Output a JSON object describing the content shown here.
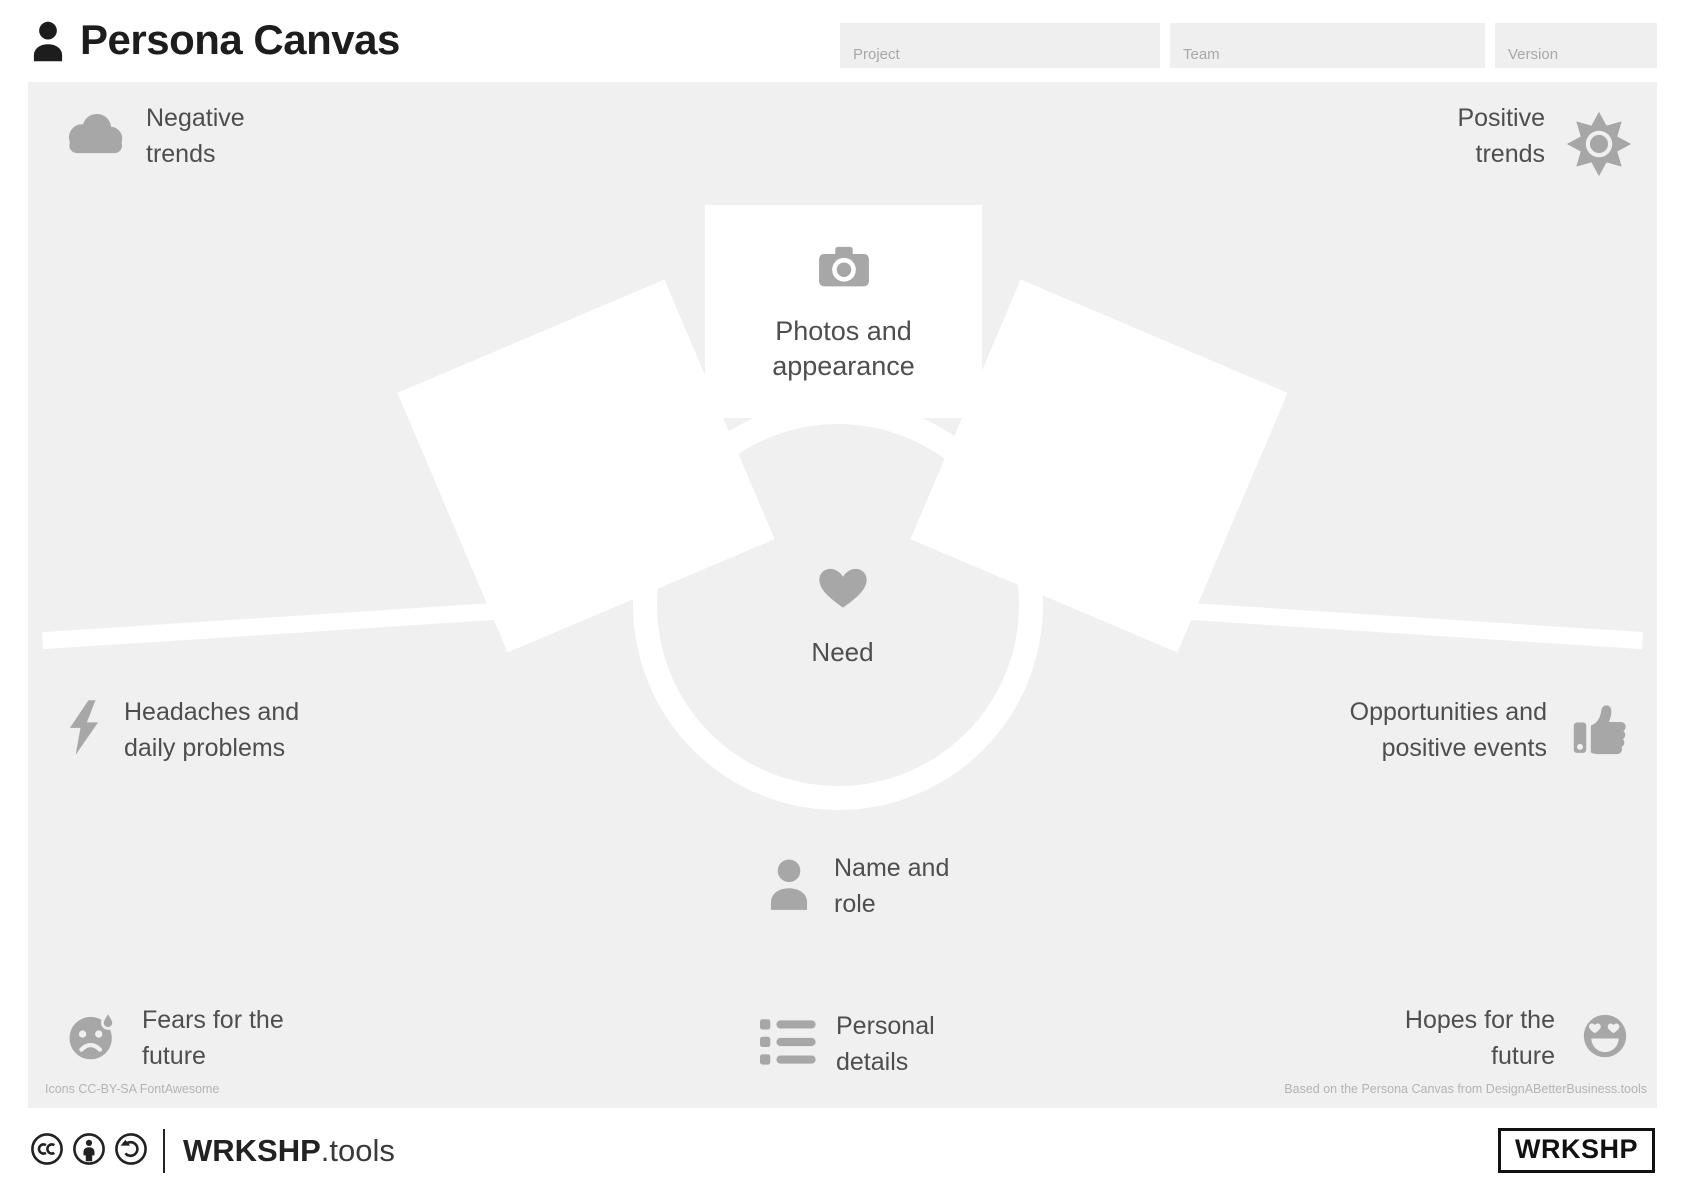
{
  "header": {
    "title": "Persona Canvas",
    "fields": {
      "project": "Project",
      "team": "Team",
      "version": "Version"
    }
  },
  "canvas": {
    "negative_trends": [
      "Negative",
      "trends"
    ],
    "positive_trends": [
      "Positive",
      "trends"
    ],
    "photos": [
      "Photos and",
      "appearance"
    ],
    "need": "Need",
    "headaches": [
      "Headaches and",
      "daily problems"
    ],
    "opportunities": [
      "Opportunities and",
      "positive events"
    ],
    "name_role": [
      "Name and",
      "role"
    ],
    "personal_details": [
      "Personal",
      "details"
    ],
    "fears": [
      "Fears for the",
      "future"
    ],
    "hopes": [
      "Hopes for the",
      "future"
    ],
    "credit_icons": "Icons CC-BY-SA FontAwesome",
    "credit_base": "Based on the Persona Canvas from DesignABetterBusiness.tools"
  },
  "footer": {
    "brand_bold": "WRKSHP",
    "brand_light": ".tools",
    "logo_box": "WRKSHP"
  },
  "colors": {
    "canvas_bg": "#f0f0f0",
    "icon_gray": "#a7a7a7",
    "text_gray": "#4e4e4e",
    "title_black": "#1d1d1d",
    "muted_text": "#b3b3b3"
  }
}
